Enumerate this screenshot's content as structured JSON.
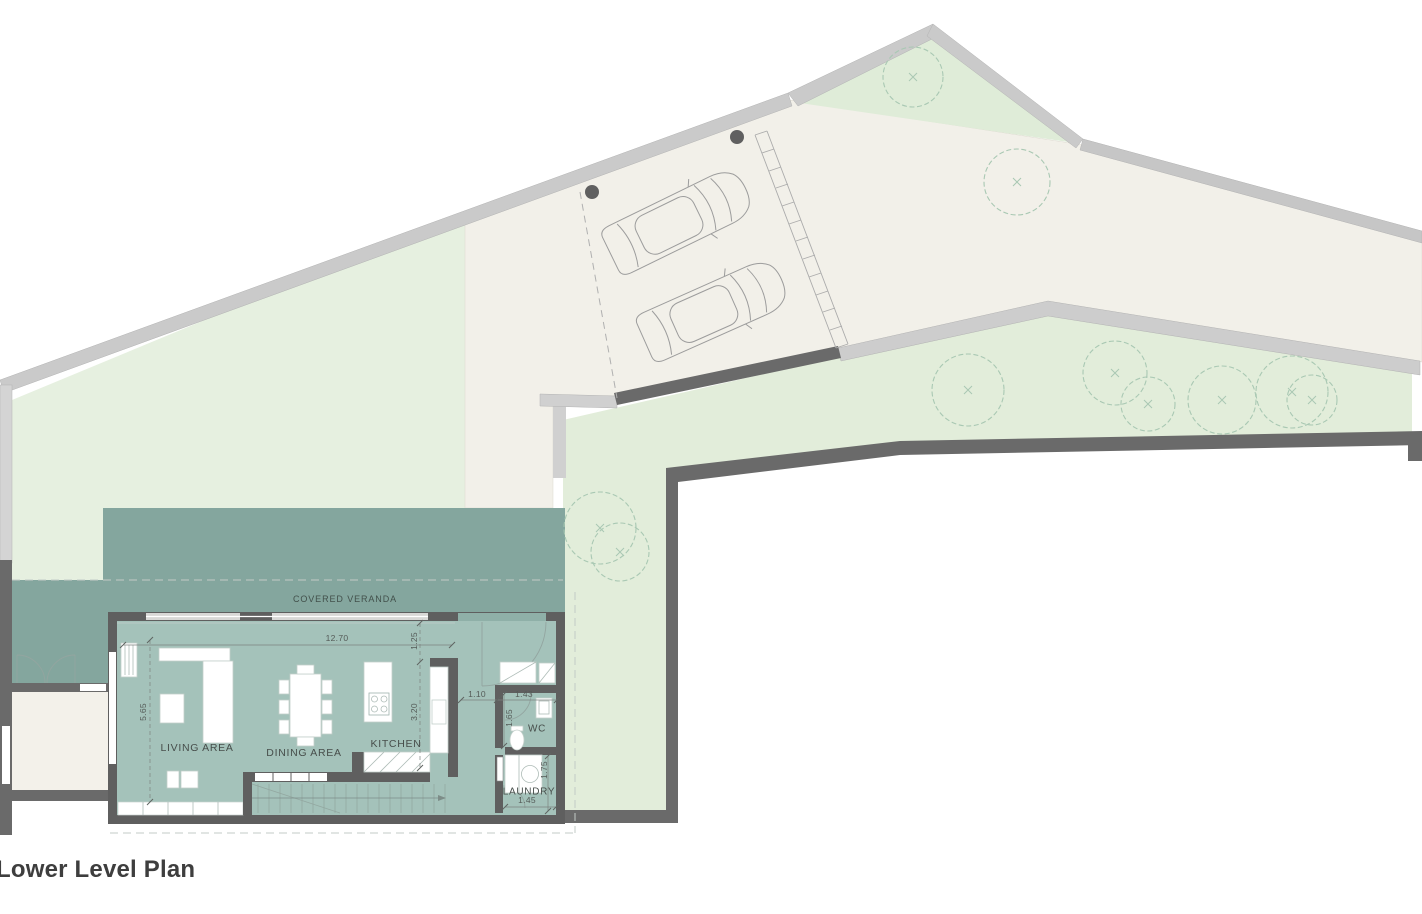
{
  "title": "Lower Level Plan",
  "veranda": {
    "label": "COVERED VERANDA"
  },
  "rooms": [
    {
      "name": "living-area",
      "label": "LIVING AREA"
    },
    {
      "name": "dining-area",
      "label": "DINING AREA"
    },
    {
      "name": "kitchen",
      "label": "KITCHEN"
    },
    {
      "name": "wc",
      "label": "WC"
    },
    {
      "name": "laundry",
      "label": "LAUNDRY"
    }
  ],
  "dimensions": [
    {
      "name": "living-width",
      "value": "12.70",
      "orientation": "horizontal"
    },
    {
      "name": "veranda-offset",
      "value": "1.25",
      "orientation": "vertical"
    },
    {
      "name": "living-depth",
      "value": "5.65",
      "orientation": "vertical"
    },
    {
      "name": "kitchen-depth",
      "value": "3.20",
      "orientation": "vertical"
    },
    {
      "name": "hall-width",
      "value": "1.10",
      "orientation": "horizontal"
    },
    {
      "name": "wc-width",
      "value": "1.43",
      "orientation": "horizontal"
    },
    {
      "name": "wc-depth",
      "value": "1.65",
      "orientation": "vertical"
    },
    {
      "name": "laundry-depth",
      "value": "1.75",
      "orientation": "vertical"
    },
    {
      "name": "laundry-width",
      "value": "1.45",
      "orientation": "horizontal"
    }
  ],
  "features": {
    "car_count": 2,
    "tree_count": 10,
    "icons": [
      "tree-icon",
      "car-icon",
      "stairs-icon",
      "toilet-icon",
      "sink-icon",
      "washer-icon",
      "sofa-icon",
      "dining-table-icon",
      "stove-icon",
      "door-swing-icon"
    ]
  },
  "colors": {
    "lawn": "#e6f0e0",
    "lawn_strip": "#e2edda",
    "lawn_triangle": "#dfecd8",
    "driveway": "#f2f0e9",
    "courtyard": "#f3f1ea",
    "veranda": "#84a69e",
    "interior": "#a4c2ba",
    "wall_house": "#5f5f5f",
    "wall_site": "#6a6a6a",
    "boundary_band": "#c9c9c9",
    "tree_stroke": "#a9c8b3",
    "label_text": "#474e4b",
    "title_text": "#3e3e3e"
  }
}
